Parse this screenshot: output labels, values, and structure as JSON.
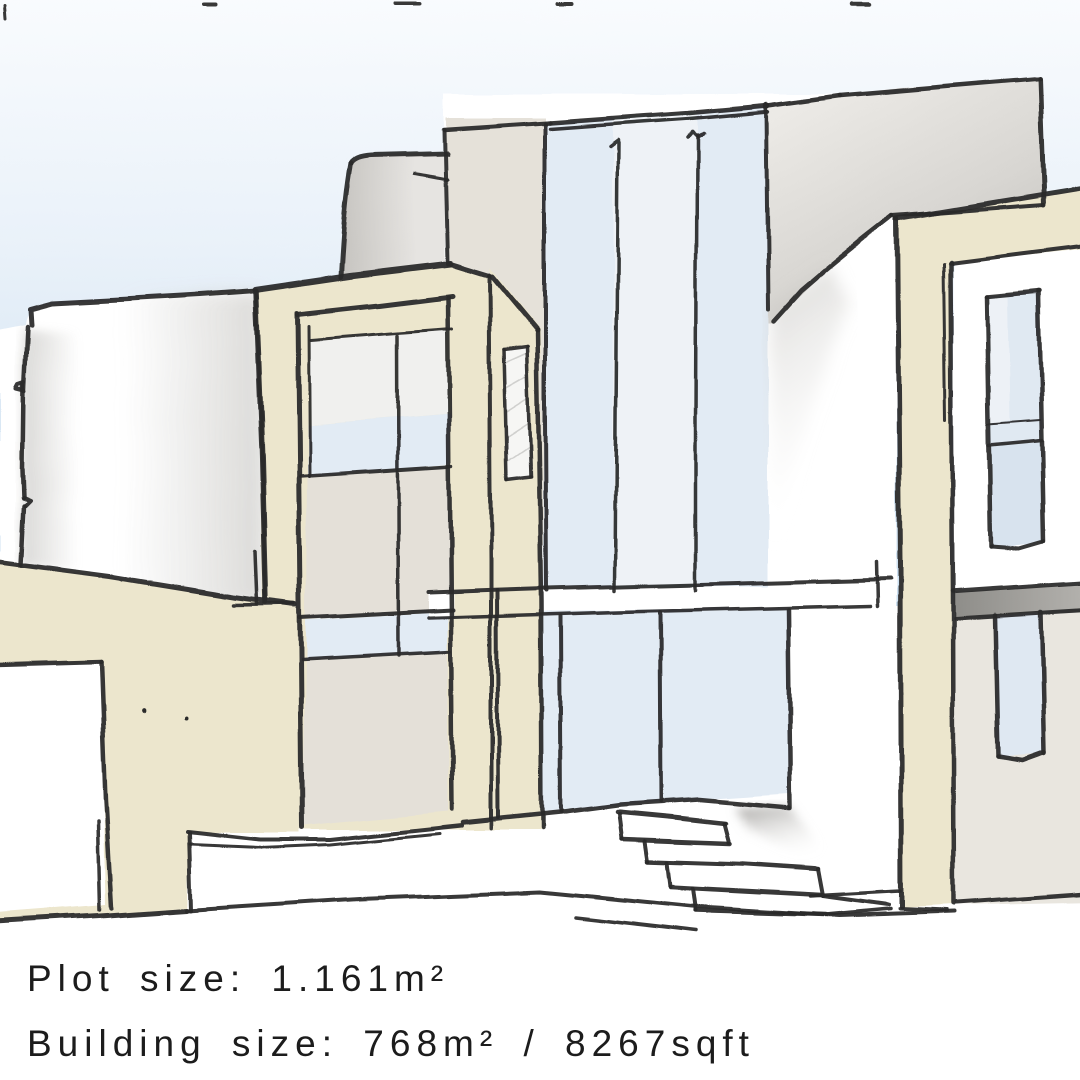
{
  "captions": {
    "plot_size": "Plot size: 1.161m²",
    "building_size": "Building size: 768m² / 8267sqft"
  },
  "palette": {
    "ink": "#2b2b2b",
    "paper": "#ffffff",
    "cream": "#ece6cd",
    "glass_blue": "#e2ebf4",
    "glass_blue_light": "#eef2f6",
    "warm_gray": "#e5e1d9",
    "slab_gray": "#a3a19d",
    "sky_top": "#fafcfe",
    "sky_bottom": "#c9def0"
  }
}
